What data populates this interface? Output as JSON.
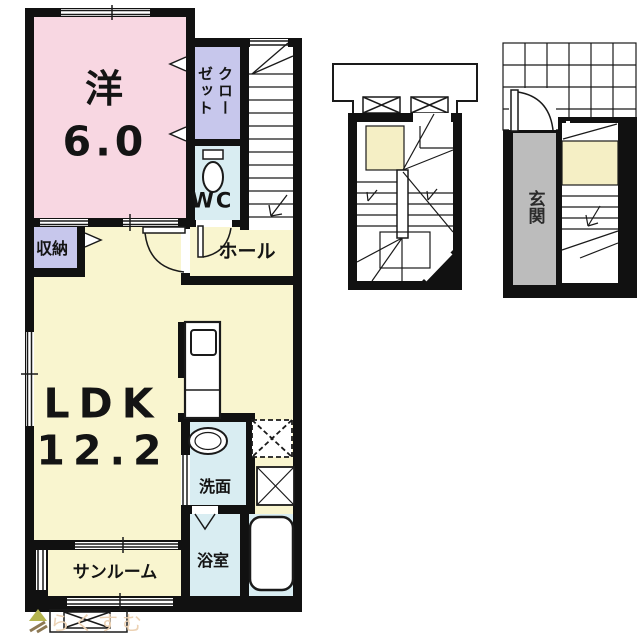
{
  "colors": {
    "wall": "#111111",
    "line": "#1a1a1a",
    "room_pink": "#f8d7e2",
    "room_yellow": "#f9f5cf",
    "room_lavender": "#c7c7ec",
    "room_blue": "#d9edf2",
    "landing_yellow": "#f5efc5",
    "entrance_gray": "#bcbcbc",
    "watermark_text": "#ecd2b4",
    "logo_olive": "#b5b54e",
    "logo_brown": "#8d7954"
  },
  "rooms": {
    "western": {
      "name": "洋",
      "size": "6.0"
    },
    "closet": {
      "label": "クローゼット"
    },
    "wc": {
      "label": "WC"
    },
    "hall": {
      "label": "ホール"
    },
    "storage": {
      "label": "収納"
    },
    "ldk": {
      "name": "LDK",
      "size": "12.2"
    },
    "washroom": {
      "label": "洗面"
    },
    "bathroom": {
      "label": "浴室"
    },
    "sunroom": {
      "label": "サンルーム"
    },
    "entrance": {
      "label": "玄関"
    }
  },
  "watermark": {
    "text": "らくすむ"
  }
}
